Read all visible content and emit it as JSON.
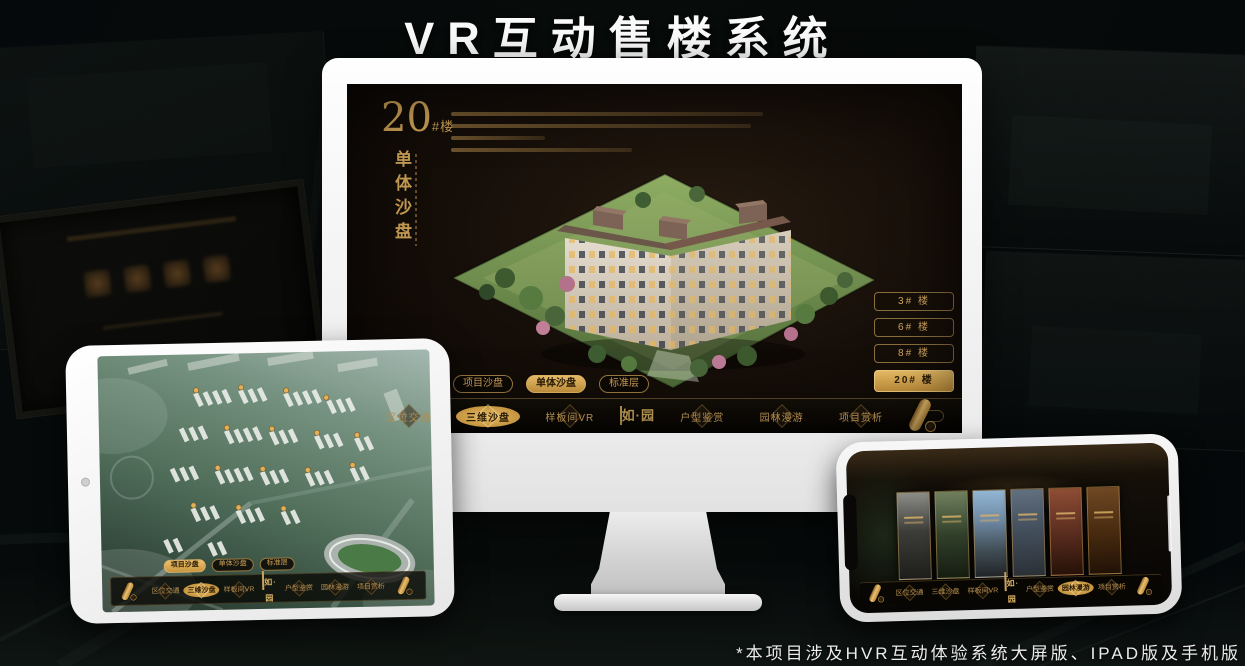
{
  "page": {
    "title": "VR互动售楼系统",
    "footnote": "*本项目涉及HVR互动体验系统大屏版、IPAD版及手机版"
  },
  "colors": {
    "gold": "#c79a4e",
    "gold_bright": "#e7bc66",
    "active_text": "#2b1c06",
    "screen_bg": "#140d08",
    "title_white": "#fafafa"
  },
  "app_nav": {
    "logo": "如·园",
    "items_left": [
      {
        "label": "区位交通"
      },
      {
        "label": "三维沙盘"
      },
      {
        "label": "样板间VR"
      }
    ],
    "items_right": [
      {
        "label": "户型鉴赏"
      },
      {
        "label": "园林漫游"
      },
      {
        "label": "项目赏析"
      }
    ]
  },
  "view_tabs": [
    {
      "label": "项目沙盘"
    },
    {
      "label": "单体沙盘"
    },
    {
      "label": "标准层"
    }
  ],
  "monitor": {
    "headline_number": "20",
    "headline_suffix": "#楼",
    "headline_subtitle": "单体沙盘",
    "active_tab": "单体沙盘",
    "active_nav": "三维沙盘",
    "active_building": "20# 楼",
    "building_buttons": [
      {
        "label": "3# 楼"
      },
      {
        "label": "6# 楼"
      },
      {
        "label": "8# 楼"
      },
      {
        "label": "20# 楼"
      }
    ]
  },
  "ipad": {
    "active_tab": "项目沙盘",
    "active_nav": "三维沙盘"
  },
  "phone": {
    "active_nav": "园林漫游"
  }
}
